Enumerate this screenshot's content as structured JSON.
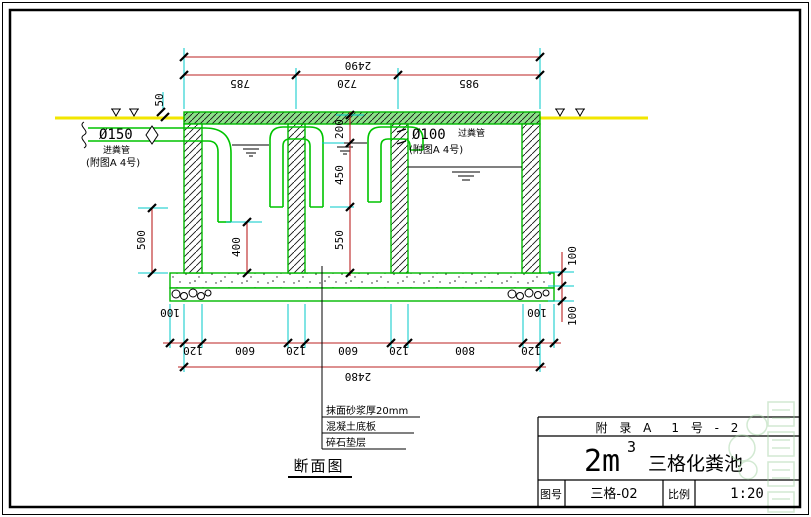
{
  "colors": {
    "dimension_line": "#bb2222",
    "extension_line": "#00c8c8",
    "structure_green": "#00b800",
    "ground_yellow": "#f2e600"
  },
  "dims": {
    "top_total": "2490",
    "top_segments": [
      "785",
      "720",
      "985"
    ],
    "top_offset": "50",
    "left": [
      "500",
      "400"
    ],
    "mid": [
      "200",
      "450",
      "550"
    ],
    "right": [
      "100",
      "100"
    ],
    "bottom_overhang_left": "100",
    "bottom_overhang_right": "100",
    "bottom_row": [
      "120",
      "600",
      "120",
      "600",
      "120",
      "800",
      "120"
    ],
    "bottom_total": "2480"
  },
  "labels": {
    "inlet": {
      "dia": "Ø150",
      "name": "进粪管",
      "ref": "(附图A 4号)"
    },
    "crossover": {
      "dia": "Ø100",
      "name": "过粪管",
      "ref": "(附图A 4号)"
    }
  },
  "notes": [
    "抹面砂浆厚20mm",
    "混凝土底板",
    "碎石垫层"
  ],
  "view_title": "断面图",
  "title_block": {
    "row1": "附 录 A　1 号 - 2",
    "title_prefix": "2m",
    "title_sup": "3",
    "title_name": "三格化粪池",
    "fig_label": "图号",
    "fig_value": "三格-02",
    "scale_label": "比例",
    "scale_value": "1:20"
  }
}
